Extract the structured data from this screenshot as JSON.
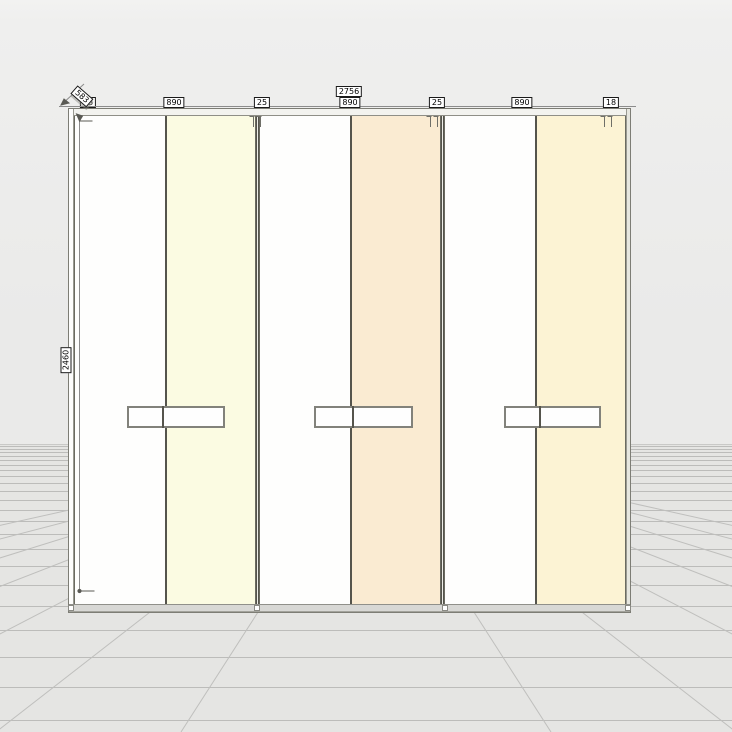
{
  "viewport": {
    "description": "3D wardrobe planner front view with dimensioning",
    "background_wall_color": "#eaeae9",
    "background_floor_color": "#e5e5e3",
    "grid_line_color": "#bcbcba"
  },
  "wardrobe": {
    "doors": [
      {
        "id": "door-1",
        "color": "#fefefd"
      },
      {
        "id": "door-2",
        "color": "#fbfbe2"
      },
      {
        "id": "door-3",
        "color": "#fefefd"
      },
      {
        "id": "door-4",
        "color": "#faebd2"
      },
      {
        "id": "door-5",
        "color": "#fefefd"
      },
      {
        "id": "door-6",
        "color": "#fcf3d4"
      }
    ],
    "divider_color": "#55544c",
    "handle_count": 3,
    "foot_count": 4
  },
  "dimensions": {
    "total_width": "2756",
    "segments": [
      "890",
      "25",
      "890",
      "25",
      "890",
      "18"
    ],
    "height": "2460",
    "depth": "583",
    "left_panel_thickness": "18",
    "label_background": "#ffffff",
    "label_border": "#1a1a1a",
    "line_color": "#8c8c8c"
  }
}
